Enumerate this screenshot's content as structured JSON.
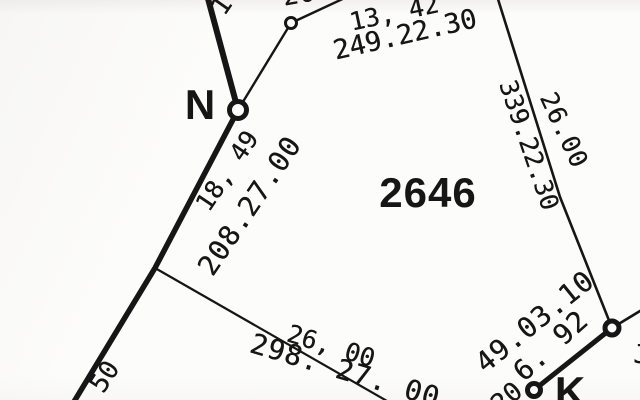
{
  "meta": {
    "image_kind": "survey-plat-scan",
    "parcel_number": "2646",
    "ink_color": "#161616",
    "paper_color": "#fcfcfb"
  },
  "labels": [
    {
      "id": "parcel-number",
      "text": "2646",
      "x": 428,
      "y": 193,
      "rot": 0,
      "size": 42,
      "ls": 1,
      "bold": true
    },
    {
      "id": "point-label-n",
      "text": "N",
      "x": 200,
      "y": 105,
      "rot": 0,
      "size": 42,
      "ls": 0,
      "bold": true
    },
    {
      "id": "point-label-k",
      "text": "K",
      "x": 570,
      "y": 392,
      "rot": 0,
      "size": 42,
      "ls": 0,
      "bold": true
    },
    {
      "id": "measurement-13-42",
      "text": "13, 42",
      "x": 394,
      "y": 13,
      "rot": -12,
      "size": 25,
      "ls": 0,
      "bold": false
    },
    {
      "id": "bearing-249-22-30",
      "text": "249.22.30",
      "x": 405,
      "y": 35,
      "rot": -13,
      "size": 27,
      "ls": 0,
      "bold": false
    },
    {
      "id": "bearing-339-22-30",
      "text": "339.22.30",
      "x": 529,
      "y": 145,
      "rot": 71,
      "size": 25,
      "ls": 0,
      "bold": false
    },
    {
      "id": "distance-26-00-east",
      "text": "26.00",
      "x": 564,
      "y": 130,
      "rot": 65,
      "size": 25,
      "ls": 1,
      "bold": false
    },
    {
      "id": "measurement-18-49",
      "text": "18, 49",
      "x": 227,
      "y": 171,
      "rot": -56,
      "size": 25,
      "ls": 0,
      "bold": false
    },
    {
      "id": "bearing-208-27-00",
      "text": "208.27.00",
      "x": 250,
      "y": 206,
      "rot": -56,
      "size": 28,
      "ls": 1,
      "bold": false
    },
    {
      "id": "measurement-50",
      "text": "50",
      "x": 105,
      "y": 377,
      "rot": -57,
      "size": 26,
      "ls": 0,
      "bold": false
    },
    {
      "id": "distance-26-00-south",
      "text": "26, 00",
      "x": 331,
      "y": 346,
      "rot": 17,
      "size": 25,
      "ls": 0,
      "bold": false
    },
    {
      "id": "bearing-298-27-00",
      "text": "298. 27. 00",
      "x": 345,
      "y": 371,
      "rot": 16.5,
      "size": 28,
      "ls": 1,
      "bold": false
    },
    {
      "id": "bearing-49-03-10",
      "text": "49.03.10",
      "x": 535,
      "y": 322,
      "rot": -39,
      "size": 28,
      "ls": 1,
      "bold": false
    },
    {
      "id": "distance-6-92",
      "text": "6. 92",
      "x": 551,
      "y": 346,
      "rot": -42,
      "size": 28,
      "ls": 1,
      "bold": false
    },
    {
      "id": "partial-digit-top-left",
      "text": "1",
      "x": 222,
      "y": 6,
      "rot": -55,
      "size": 26,
      "ls": 0,
      "bold": false
    },
    {
      "id": "partial-digits-top",
      "text": "20",
      "x": 299,
      "y": -5,
      "rot": -10,
      "size": 26,
      "ls": 1,
      "bold": false
    },
    {
      "id": "partial-digits-bottom",
      "text": "20",
      "x": 507,
      "y": 398,
      "rot": -40,
      "size": 26,
      "ls": 0,
      "bold": false
    },
    {
      "id": "partial-char-right-edge",
      "text": "J",
      "x": 641,
      "y": 355,
      "rot": 0,
      "size": 26,
      "ls": 0,
      "bold": false
    }
  ],
  "lines": [
    {
      "id": "boundary-line-north",
      "points": "207,-5 238,110",
      "width": 6
    },
    {
      "id": "boundary-line-west",
      "points": "238,110 155,268 72,405",
      "width": 5.5
    },
    {
      "id": "boundary-line-k-segment",
      "points": "534,390 612,328",
      "width": 5
    },
    {
      "id": "tie-line-n-to-marker",
      "points": "238,110 291,23 349,-4",
      "width": 2.4
    },
    {
      "id": "boundary-line-east",
      "points": "497,-4 560,197 612,328",
      "width": 2.6
    },
    {
      "id": "boundary-line-south",
      "points": "155,268 394,405",
      "width": 2.2
    },
    {
      "id": "tie-line-east-edge",
      "points": "612,328 645,308",
      "width": 2.6
    }
  ],
  "nodes": [
    {
      "id": "survey-marker-upper",
      "cx": 291,
      "cy": 23,
      "r": 5.5,
      "sw": 3
    },
    {
      "id": "survey-marker-n",
      "cx": 238,
      "cy": 110,
      "r": 8.5,
      "sw": 5
    },
    {
      "id": "survey-marker-east",
      "cx": 612,
      "cy": 328,
      "r": 7,
      "sw": 5
    },
    {
      "id": "survey-marker-k",
      "cx": 534,
      "cy": 390,
      "r": 6.5,
      "sw": 5
    }
  ]
}
